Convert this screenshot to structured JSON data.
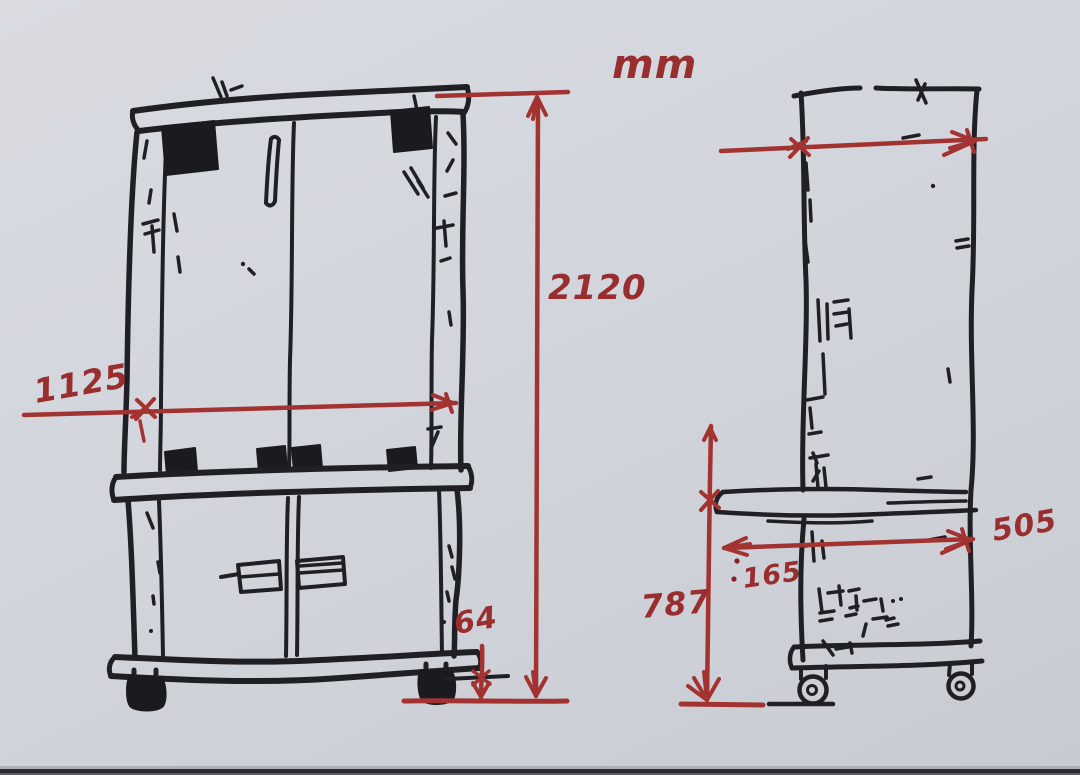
{
  "sketch": {
    "unit": "mm",
    "colors": {
      "ink": "#202024",
      "red": "#a23331",
      "paper": "#d3d5dd"
    },
    "front_view": {
      "name": "cabinet front elevation with doors, hinges and casters",
      "dim_total_height": "2120",
      "dim_total_width": "1125",
      "dim_caster_height": "64"
    },
    "side_view": {
      "name": "cabinet side elevation with worktop and casters",
      "dim_worktop_to_floor": "787",
      "dim_worktop_overhang": "165",
      "dim_depth": "505"
    }
  }
}
